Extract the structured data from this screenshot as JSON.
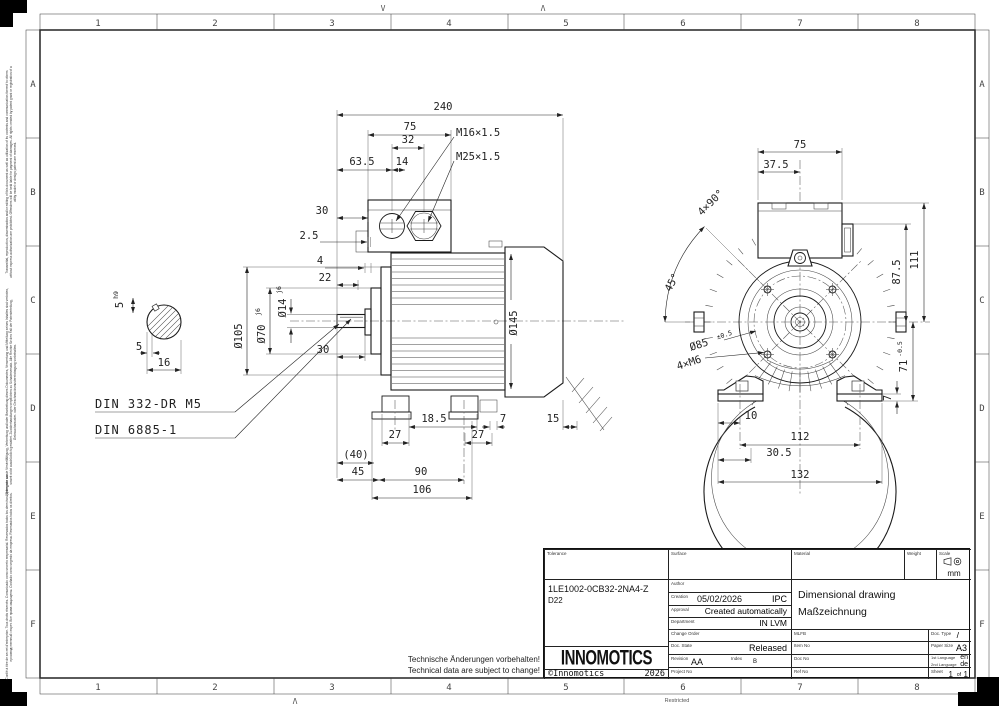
{
  "border": {
    "columns": [
      "1",
      "2",
      "3",
      "4",
      "5",
      "6",
      "7",
      "8"
    ],
    "rows": [
      "A",
      "B",
      "C",
      "D",
      "E",
      "F"
    ],
    "fold_mark_v": "V",
    "fold_mark_caret": "Λ",
    "restricted": "Restricted"
  },
  "legal": {
    "en": "Transmittal, reproduction, dissemination and/or editing of this document as well as utilization of its contents and communication thereof to others without express authorization are prohibited. Offenders will be held liable for payment of damages. All rights created by patent grant or registration of a utility model or design patent are reserved.",
    "de": "Weitergabe sowie Vervielfältigung, Verbreitung und/oder Bearbeitung dieses Dokumentes, Verwertung und Mitteilung seines Inhaltes sind verboten, soweit nicht ausdrücklich gestattet. Zuwiderhandlungen verpflichten zu Schadenersatz. Alle Rechte für den Fall der Patenterteilung, Gebrauchsmuster- oder Geschmacksmustereintragung vorbehalten.",
    "multi": "Confié à titre de secret d'entreprise. Tous droits réservés. Comunicado como secreto empresarial. Reservados todos los derechos. Доверено как производственный секрет. Все права защищены. Confiado como segredo da empresa. Reservados todos os direitos."
  },
  "notes": {
    "de": "Technische Änderungen vorbehalten!",
    "en": "Technical data are subject to change!"
  },
  "side_view": {
    "total_length": "240",
    "box_width": "75",
    "gland_pitch": "32",
    "gland_pos": "63.5",
    "gland_offset": "14",
    "gland_small": "M16×1.5",
    "gland_large": "M25×1.5",
    "datum_to_box": "30",
    "gap": "2.5",
    "shoulder": "4",
    "spigot_len": "22",
    "spigot_depth": "30",
    "dia_flange": "Ø105",
    "dia_spigot": "Ø70",
    "dia_spigot_tol": "j6",
    "dia_shaft": "Ø14",
    "dia_shaft_tol": "j6",
    "dia_body": "Ø145",
    "key_width": "5",
    "key_width_tol": "h9",
    "key_depth": "5",
    "section_width": "16",
    "din_center_hole": "DIN 332-DR M5",
    "din_key": "DIN 6885-1",
    "foot_slot": "18.5",
    "pad_height": "7",
    "foot_front_width": "27",
    "foot_rear_width": "27",
    "overhang": "(40)",
    "shaft_length": "45",
    "foot_span": "90",
    "base_length": "106",
    "clearance": "15"
  },
  "front_view": {
    "box_width": "75",
    "box_half_width": "37.5",
    "hole_pattern": "4×90°",
    "hole_angle": "45°",
    "height_box": "111",
    "height_connector": "87.5",
    "dia_spigot": "Ø85",
    "dia_spigot_tol": "±0.5",
    "flange_holes": "4×M6",
    "shaft_height": "71",
    "shaft_height_tol": "-0.5",
    "pad_height": "7",
    "hole_to_edge": "10",
    "hole_span": "112",
    "pad_offset": "30.5",
    "base_width": "132"
  },
  "title_block": {
    "labels": {
      "tolerance": "Tolerance",
      "surface": "Surface",
      "material": "Material",
      "weight": "Weight",
      "scale": "Scale",
      "author": "Author",
      "creation": "Creation",
      "approval": "Approval",
      "department": "Department",
      "change_order": "Change Order",
      "doc_state": "Doc. State",
      "revision": "Revision",
      "index": "Index",
      "project_no": "Project No",
      "mlfb": "MLFB",
      "item_no": "Item No",
      "doc_no": "Doc No",
      "ref_no": "Ref No",
      "doc_type": "Doc. Type",
      "paper_size": "Paper Size",
      "lang1": "1st Language",
      "lang2": "2nd Language",
      "sheet": "Sheet",
      "sheet_of": "of"
    },
    "values": {
      "part_number": "1LE1002-0CB32-2NA4-Z",
      "part_variant": "D22",
      "creation_date": "05/02/2026",
      "creation_org": "IPC",
      "approval": "Created automatically",
      "department": "IN LVM",
      "doc_state": "Released",
      "revision": "AA",
      "index": "B",
      "title_line1": "Dimensional drawing",
      "title_line2": "Maßzeichnung",
      "doc_type": "/",
      "paper_size": "A3",
      "lang1": "en",
      "lang2": "de",
      "sheet_no": "1",
      "sheet_total": "1",
      "unit": "mm",
      "logo": "INNOMOTICS",
      "copyright": "©Innomotics",
      "year": "2026"
    }
  }
}
